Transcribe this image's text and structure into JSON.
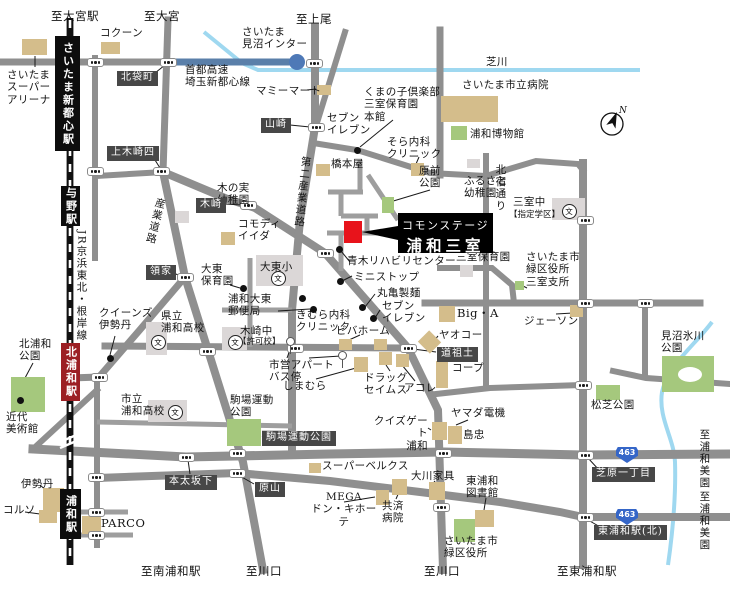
{
  "site": {
    "name_line1": "コモンステージ",
    "name_line2": "浦和三室",
    "marker_color": "#e8131b"
  },
  "compass": {
    "label": "N"
  },
  "map": {
    "school_glyph": "文",
    "route_shields": [
      {
        "id": "route-463-upper",
        "number": "463",
        "x": 616,
        "y": 447
      },
      {
        "id": "route-463-lower",
        "number": "463",
        "x": 616,
        "y": 509
      }
    ],
    "stations": [
      {
        "id": "station-saitama-shintoshin",
        "name": "さいたま新都心駅",
        "x": 55,
        "y": 36,
        "w": 25,
        "h": 115,
        "bg": "#0d0d0d"
      },
      {
        "id": "station-yono",
        "name": "与野駅",
        "x": 61,
        "y": 186,
        "w": 19,
        "h": 40,
        "bg": "#0d0d0d"
      },
      {
        "id": "station-kita-urawa",
        "name": "北浦和駅",
        "x": 61,
        "y": 343,
        "w": 19,
        "h": 58,
        "bg": "#9c1f24"
      },
      {
        "id": "station-urawa",
        "name": "浦和駅",
        "x": 60,
        "y": 489,
        "w": 21,
        "h": 50,
        "bg": "#0d0d0d"
      }
    ],
    "intersection_labels": [
      {
        "id": "xing-kitabukuro",
        "text": "北袋町",
        "x": 117,
        "y": 71
      },
      {
        "id": "xing-kamikizaki4",
        "text": "上木崎四",
        "x": 107,
        "y": 146
      },
      {
        "id": "xing-yamazaki",
        "text": "山崎",
        "x": 261,
        "y": 118
      },
      {
        "id": "xing-kizaki",
        "text": "木崎",
        "x": 196,
        "y": 198
      },
      {
        "id": "xing-ryoke",
        "text": "領家",
        "x": 146,
        "y": 265
      },
      {
        "id": "xing-saido",
        "text": "道祖土",
        "x": 437,
        "y": 347
      },
      {
        "id": "xing-motobuto-sakashita",
        "text": "本太坂下",
        "x": 165,
        "y": 475
      },
      {
        "id": "xing-harayama",
        "text": "原山",
        "x": 255,
        "y": 482
      },
      {
        "id": "xing-shibahara-itchome",
        "text": "芝原一丁目",
        "x": 592,
        "y": 467
      },
      {
        "id": "xing-higashi-urawa-kita",
        "text": "東浦和駅(北)",
        "x": 594,
        "y": 525
      },
      {
        "id": "busstop-komaba-undo-koen",
        "text": "駒場運動公園",
        "x": 262,
        "y": 431
      }
    ],
    "text_labels": [
      {
        "id": "to-omiya-sta",
        "text": "至大宮駅",
        "x": 51,
        "y": 10,
        "cls": "lat"
      },
      {
        "id": "to-omiya",
        "text": "至大宮",
        "x": 144,
        "y": 10,
        "cls": "lat"
      },
      {
        "id": "to-ageo",
        "text": "至上尾",
        "x": 296,
        "y": 13,
        "cls": "lat"
      },
      {
        "id": "cocoon",
        "text": "コクーン",
        "x": 100,
        "y": 27
      },
      {
        "id": "saitama-minuma-ic",
        "text": "さいたま\n見沼インター",
        "x": 242,
        "y": 26
      },
      {
        "id": "shuto-expressway",
        "text": "首都高速\n埼玉新都心線",
        "x": 185,
        "y": 64
      },
      {
        "id": "shibakawa-river",
        "text": "芝川",
        "x": 486,
        "y": 56
      },
      {
        "id": "saitama-city-hospital",
        "text": "さいたま市立病院",
        "x": 462,
        "y": 79
      },
      {
        "id": "urawa-museum",
        "text": "浦和博物館",
        "x": 470,
        "y": 128
      },
      {
        "id": "mamy-mart",
        "text": "マミーマート",
        "x": 256,
        "y": 85
      },
      {
        "id": "seven-eleven-north",
        "text": "セブン\nイレブン",
        "x": 327,
        "y": 112
      },
      {
        "id": "kumanoko-mimuro-hoikuen",
        "text": "くまの子倶楽部\n三室保育園\n本館",
        "x": 364,
        "y": 86
      },
      {
        "id": "sora-naika-clinic",
        "text": "そら内科\nクリニック",
        "x": 387,
        "y": 136
      },
      {
        "id": "hashimotoya",
        "text": "橋本屋",
        "x": 331,
        "y": 158
      },
      {
        "id": "harasaki-koen",
        "text": "原前\n公園",
        "x": 419,
        "y": 165
      },
      {
        "id": "kitajuku-dori",
        "text": "北宿通り",
        "x": 494,
        "y": 164,
        "cls": "vert"
      },
      {
        "id": "furusato-yochien",
        "text": "ふるさと\n幼稚園",
        "x": 464,
        "y": 175
      },
      {
        "id": "mimuro-chugakko",
        "text": "三室中",
        "x": 513,
        "y": 196
      },
      {
        "id": "mimuro-chu-shitei-gakku",
        "text": "【指定学区】",
        "x": 509,
        "y": 210,
        "cls": "small"
      },
      {
        "id": "mimuro-hoikuen",
        "text": "三室保育園",
        "x": 456,
        "y": 251
      },
      {
        "id": "midori-kuyakusho-mimuro-shisho",
        "text": "さいたま市\n緑区役所\n三室支所",
        "x": 526,
        "y": 251
      },
      {
        "id": "aoki-rehabili-center",
        "text": "青木リハビリセンター",
        "x": 347,
        "y": 255
      },
      {
        "id": "ministop",
        "text": "ミニストップ",
        "x": 354,
        "y": 271
      },
      {
        "id": "marugame-seimen",
        "text": "丸亀製麺",
        "x": 377,
        "y": 287
      },
      {
        "id": "seven-eleven-saido",
        "text": "セブン\nイレブン",
        "x": 382,
        "y": 300
      },
      {
        "id": "viva-home",
        "text": "ビバホーム",
        "x": 336,
        "y": 325
      },
      {
        "id": "yaoko",
        "text": "ヤオコー",
        "x": 439,
        "y": 329
      },
      {
        "id": "co-op",
        "text": "コープ",
        "x": 452,
        "y": 362
      },
      {
        "id": "drug-seims",
        "text": "ドラッグ\nセイムス",
        "x": 364,
        "y": 372
      },
      {
        "id": "acole",
        "text": "アコレ",
        "x": 404,
        "y": 382
      },
      {
        "id": "shimamura",
        "text": "しまむら",
        "x": 283,
        "y": 380
      },
      {
        "id": "kimura-naika-clinic",
        "text": "きむら内科\nクリニック",
        "x": 296,
        "y": 309
      },
      {
        "id": "shiei-apart-busstop",
        "text": "市営アパート\nバス停",
        "x": 269,
        "y": 359
      },
      {
        "id": "kizaki-chugakko",
        "text": "木崎中",
        "x": 240,
        "y": 325
      },
      {
        "id": "kizaki-chu-kyokako",
        "text": "【許可校】",
        "x": 238,
        "y": 337,
        "cls": "small"
      },
      {
        "id": "daito-shogakko",
        "text": "大東小",
        "x": 260,
        "y": 261
      },
      {
        "id": "daito-hoikuen",
        "text": "大東\n保育園",
        "x": 201,
        "y": 263
      },
      {
        "id": "urawa-daito-post-office",
        "text": "浦和大東\n郵便局",
        "x": 228,
        "y": 293
      },
      {
        "id": "queens-isetan",
        "text": "クイーンズ\n伊勢丹",
        "x": 99,
        "y": 307
      },
      {
        "id": "kenritsu-urawa-koko",
        "text": "県立\n浦和高校",
        "x": 161,
        "y": 310
      },
      {
        "id": "shiritsu-urawa-koko",
        "text": "市立\n浦和高校",
        "x": 121,
        "y": 393
      },
      {
        "id": "kita-urawa-koen",
        "text": "北浦和\n公園",
        "x": 19,
        "y": 338
      },
      {
        "id": "kindai-bijutsukan",
        "text": "近代\n美術館",
        "x": 6,
        "y": 411
      },
      {
        "id": "isetan",
        "text": "伊勢丹",
        "x": 21,
        "y": 478
      },
      {
        "id": "corso",
        "text": "コルソ",
        "x": 3,
        "y": 504
      },
      {
        "id": "parco",
        "text": "PARCO",
        "x": 101,
        "y": 517,
        "cls": "lat"
      },
      {
        "id": "to-minami-urawa-sta",
        "text": "至南浦和駅",
        "x": 141,
        "y": 565,
        "cls": "lat"
      },
      {
        "id": "komaba-undo-koen",
        "text": "駒場運動\n公園",
        "x": 230,
        "y": 394
      },
      {
        "id": "super-belx",
        "text": "スーパーベルクス",
        "x": 322,
        "y": 460
      },
      {
        "id": "mega-don-quijote",
        "text": "MEGA\nドン・キホーテ",
        "x": 309,
        "y": 491,
        "cls": "center",
        "w": 70
      },
      {
        "id": "kyosai-byoin",
        "text": "共済\n病院",
        "x": 382,
        "y": 500
      },
      {
        "id": "okawa-kagu",
        "text": "大川家具",
        "x": 411,
        "y": 470
      },
      {
        "id": "higashi-urawa-toshokan",
        "text": "東浦和\n図書館",
        "x": 466,
        "y": 475
      },
      {
        "id": "saitama-midori-kuyakusho",
        "text": "さいたま市\n緑区役所",
        "x": 444,
        "y": 535
      },
      {
        "id": "to-kawaguchi-west",
        "text": "至川口",
        "x": 246,
        "y": 565,
        "cls": "lat"
      },
      {
        "id": "to-kawaguchi-east",
        "text": "至川口",
        "x": 424,
        "y": 565,
        "cls": "lat"
      },
      {
        "id": "to-higashi-urawa-sta",
        "text": "至東浦和駅",
        "x": 557,
        "y": 565,
        "cls": "lat"
      },
      {
        "id": "yamada-denki",
        "text": "ヤマダ電機",
        "x": 451,
        "y": 407
      },
      {
        "id": "quiz-gate-urawa",
        "text": "クイズゲート\n浦和",
        "x": 371,
        "y": 415,
        "cls": "right",
        "w": 57
      },
      {
        "id": "shimachu",
        "text": "島忠",
        "x": 463,
        "y": 429
      },
      {
        "id": "jason",
        "text": "ジェーソン",
        "x": 524,
        "y": 315
      },
      {
        "id": "matsushiba-koen",
        "text": "松芝公園",
        "x": 591,
        "y": 399
      },
      {
        "id": "minuma-hikawa-koen",
        "text": "見沼氷川\n公園",
        "x": 661,
        "y": 330
      },
      {
        "id": "big-a",
        "text": "Big・A",
        "x": 457,
        "y": 307,
        "cls": "lat"
      },
      {
        "id": "commodi-iida",
        "text": "コモディ\nイイダ",
        "x": 238,
        "y": 218
      },
      {
        "id": "kinomi-yochien",
        "text": "木の実\n幼稚園",
        "x": 217,
        "y": 182
      },
      {
        "id": "sangyo-doro",
        "text": "産業道路",
        "x": 149,
        "y": 197,
        "cls": "vert",
        "rot": 14
      },
      {
        "id": "dai2-sangyo-doro",
        "text": "第二産業道路",
        "x": 296,
        "y": 156,
        "cls": "vert",
        "rot": 6
      },
      {
        "id": "jr-keihin-tohoku-negishi-line",
        "text": "JR京浜東北・根岸線",
        "x": 75,
        "y": 230,
        "cls": "vert"
      },
      {
        "id": "to-urawa-misono-upper",
        "text": "至浦和美園",
        "x": 698,
        "y": 429,
        "cls": "vert"
      },
      {
        "id": "to-urawa-misono-lower",
        "text": "至浦和美園",
        "x": 698,
        "y": 491,
        "cls": "vert"
      },
      {
        "id": "saitama-super-arena",
        "text": "さいたま\nスーパー\nアリーナ",
        "x": 7,
        "y": 69
      }
    ],
    "buildings": [
      {
        "id": "bld-saitama-super-arena",
        "x": 22,
        "y": 39,
        "w": 25,
        "h": 16,
        "fill": "tan"
      },
      {
        "id": "bld-cocoon",
        "x": 101,
        "y": 42,
        "w": 19,
        "h": 12,
        "fill": "tan"
      },
      {
        "id": "bld-mamy-mart",
        "x": 317,
        "y": 85,
        "w": 14,
        "h": 10,
        "fill": "tan"
      },
      {
        "id": "bld-city-hospital",
        "x": 441,
        "y": 96,
        "w": 57,
        "h": 26,
        "fill": "tan"
      },
      {
        "id": "bld-hashimotoya",
        "x": 316,
        "y": 164,
        "w": 14,
        "h": 12,
        "fill": "tan"
      },
      {
        "id": "bld-sora-clinic",
        "x": 411,
        "y": 163,
        "w": 13,
        "h": 13,
        "fill": "tan"
      },
      {
        "id": "bld-commodi-iida",
        "x": 221,
        "y": 232,
        "w": 14,
        "h": 13,
        "fill": "tan"
      },
      {
        "id": "bld-big-a",
        "x": 439,
        "y": 306,
        "w": 16,
        "h": 16,
        "fill": "tan"
      },
      {
        "id": "bld-viva-home-1",
        "x": 339,
        "y": 339,
        "w": 13,
        "h": 11,
        "fill": "tan"
      },
      {
        "id": "bld-viva-home-2",
        "x": 374,
        "y": 339,
        "w": 13,
        "h": 11,
        "fill": "tan"
      },
      {
        "id": "bld-shimamura",
        "x": 354,
        "y": 357,
        "w": 14,
        "h": 15,
        "fill": "tan"
      },
      {
        "id": "bld-drug-seims",
        "x": 379,
        "y": 352,
        "w": 13,
        "h": 13,
        "fill": "tan"
      },
      {
        "id": "bld-acole",
        "x": 396,
        "y": 354,
        "w": 13,
        "h": 13,
        "fill": "tan"
      },
      {
        "id": "bld-co-op",
        "x": 436,
        "y": 361,
        "w": 12,
        "h": 27,
        "fill": "tan"
      },
      {
        "id": "bld-yaoko",
        "x": 421,
        "y": 334,
        "w": 17,
        "h": 16,
        "fill": "tan",
        "rot": 45
      },
      {
        "id": "bld-quiz-gate",
        "x": 432,
        "y": 422,
        "w": 15,
        "h": 18,
        "fill": "tan"
      },
      {
        "id": "bld-shimachu",
        "x": 448,
        "y": 426,
        "w": 14,
        "h": 18,
        "fill": "tan"
      },
      {
        "id": "bld-super-belx",
        "x": 309,
        "y": 463,
        "w": 12,
        "h": 10,
        "fill": "tan"
      },
      {
        "id": "bld-mega-donki",
        "x": 376,
        "y": 490,
        "w": 13,
        "h": 15,
        "fill": "tan"
      },
      {
        "id": "bld-kyosai-byoin",
        "x": 392,
        "y": 479,
        "w": 15,
        "h": 16,
        "fill": "tan"
      },
      {
        "id": "bld-okawa-kagu",
        "x": 429,
        "y": 482,
        "w": 16,
        "h": 18,
        "fill": "tan"
      },
      {
        "id": "bld-library",
        "x": 475,
        "y": 510,
        "w": 19,
        "h": 17,
        "fill": "tan"
      },
      {
        "id": "bld-jason",
        "x": 570,
        "y": 305,
        "w": 13,
        "h": 12,
        "fill": "tan"
      },
      {
        "id": "bld-isetan",
        "x": 43,
        "y": 488,
        "w": 21,
        "h": 24,
        "fill": "tan"
      },
      {
        "id": "bld-corso",
        "x": 39,
        "y": 510,
        "w": 18,
        "h": 13,
        "fill": "tan"
      },
      {
        "id": "bld-parco",
        "x": 82,
        "y": 516,
        "w": 19,
        "h": 18,
        "fill": "tan"
      },
      {
        "id": "bld-mimuro-chu",
        "x": 552,
        "y": 198,
        "w": 33,
        "h": 22,
        "fill": "gray"
      },
      {
        "id": "bld-daito-sho",
        "x": 256,
        "y": 255,
        "w": 47,
        "h": 31,
        "fill": "gray"
      },
      {
        "id": "bld-kenritsu-urawa-koko",
        "x": 146,
        "y": 322,
        "w": 21,
        "h": 33,
        "fill": "gray"
      },
      {
        "id": "bld-shiritsu-urawa-koko",
        "x": 148,
        "y": 400,
        "w": 39,
        "h": 22,
        "fill": "gray"
      },
      {
        "id": "bld-kizaki-chu",
        "x": 222,
        "y": 327,
        "w": 25,
        "h": 23,
        "fill": "gray"
      },
      {
        "id": "bld-furusato-yochien",
        "x": 467,
        "y": 159,
        "w": 13,
        "h": 9,
        "fill": "gray"
      },
      {
        "id": "bld-kinomi-yochien",
        "x": 175,
        "y": 211,
        "w": 14,
        "h": 12,
        "fill": "gray"
      },
      {
        "id": "bld-mimuro-hoikuen",
        "x": 460,
        "y": 265,
        "w": 13,
        "h": 12,
        "fill": "gray"
      },
      {
        "id": "park-urawa-museum",
        "x": 451,
        "y": 126,
        "w": 16,
        "h": 14,
        "fill": "green"
      },
      {
        "id": "park-harasaki",
        "x": 382,
        "y": 197,
        "w": 12,
        "h": 16,
        "fill": "green"
      },
      {
        "id": "park-komaba",
        "x": 227,
        "y": 419,
        "w": 34,
        "h": 27,
        "fill": "green"
      },
      {
        "id": "park-kita-urawa",
        "x": 11,
        "y": 377,
        "w": 34,
        "h": 35,
        "fill": "green"
      },
      {
        "id": "park-matsushiba",
        "x": 596,
        "y": 385,
        "w": 24,
        "h": 15,
        "fill": "green"
      },
      {
        "id": "bld-midori-kuyakusho",
        "x": 454,
        "y": 519,
        "w": 21,
        "h": 23,
        "fill": "green"
      },
      {
        "id": "bld-mimuro-shisho",
        "x": 515,
        "y": 281,
        "w": 9,
        "h": 9,
        "fill": "green"
      },
      {
        "id": "park-minuma-hikawa",
        "x": 662,
        "y": 356,
        "w": 52,
        "h": 36,
        "fill": "green"
      }
    ],
    "poi_dots": [
      {
        "x": 357,
        "y": 150
      },
      {
        "x": 20,
        "y": 400
      },
      {
        "x": 110,
        "y": 358
      },
      {
        "x": 243,
        "y": 288
      },
      {
        "x": 302,
        "y": 298
      },
      {
        "x": 313,
        "y": 309
      },
      {
        "x": 339,
        "y": 249
      },
      {
        "x": 340,
        "y": 281
      },
      {
        "x": 362,
        "y": 307
      },
      {
        "x": 373,
        "y": 318
      }
    ],
    "crossings": [
      {
        "x": 95,
        "y": 62
      },
      {
        "x": 168,
        "y": 62
      },
      {
        "x": 314,
        "y": 63
      },
      {
        "x": 95,
        "y": 171
      },
      {
        "x": 161,
        "y": 171
      },
      {
        "x": 316,
        "y": 127
      },
      {
        "x": 248,
        "y": 205
      },
      {
        "x": 185,
        "y": 277
      },
      {
        "x": 325,
        "y": 253
      },
      {
        "x": 207,
        "y": 351
      },
      {
        "x": 295,
        "y": 348
      },
      {
        "x": 408,
        "y": 348
      },
      {
        "x": 99,
        "y": 377
      },
      {
        "x": 186,
        "y": 457
      },
      {
        "x": 237,
        "y": 453
      },
      {
        "x": 237,
        "y": 473
      },
      {
        "x": 443,
        "y": 453
      },
      {
        "x": 441,
        "y": 507
      },
      {
        "x": 585,
        "y": 220
      },
      {
        "x": 585,
        "y": 303
      },
      {
        "x": 645,
        "y": 303
      },
      {
        "x": 583,
        "y": 385
      },
      {
        "x": 585,
        "y": 455
      },
      {
        "x": 585,
        "y": 517
      },
      {
        "x": 96,
        "y": 477
      },
      {
        "x": 96,
        "y": 512
      },
      {
        "x": 96,
        "y": 535
      }
    ],
    "school_icons": [
      {
        "x": 277,
        "y": 277
      },
      {
        "x": 234,
        "y": 341
      },
      {
        "x": 157,
        "y": 341
      },
      {
        "x": 174,
        "y": 411
      },
      {
        "x": 568,
        "y": 210
      }
    ],
    "bus_stops": [
      {
        "x": 291,
        "y": 341
      },
      {
        "x": 343,
        "y": 355
      }
    ]
  }
}
